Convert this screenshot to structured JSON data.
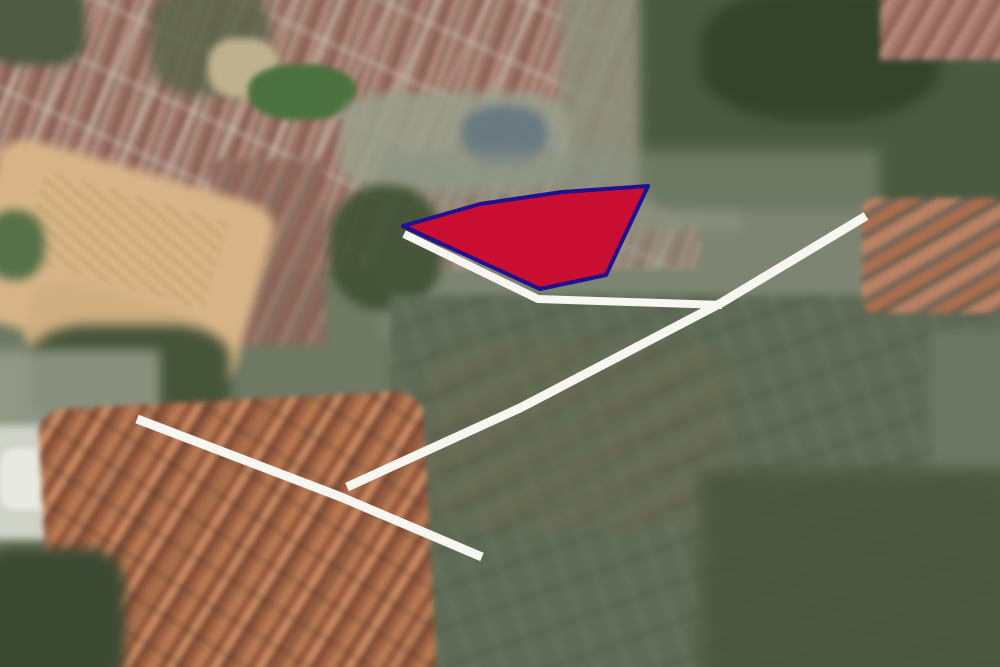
{
  "map": {
    "kind": "oblique-aerial-satellite-view",
    "canvas_width": 1000,
    "canvas_height": 667
  },
  "overlay": {
    "road_color": "#f8f6f0",
    "roads": [
      {
        "name": "parcel-frontage-road",
        "width": 8,
        "points": [
          [
            404,
            234
          ],
          [
            538,
            299
          ],
          [
            722,
            305
          ]
        ]
      },
      {
        "name": "main-access-road",
        "width": 9,
        "points": [
          [
            866,
            216
          ],
          [
            721,
            303
          ],
          [
            520,
            408
          ],
          [
            347,
            487
          ]
        ]
      },
      {
        "name": "cross-road",
        "width": 9,
        "points": [
          [
            137,
            419
          ],
          [
            341,
            497
          ],
          [
            482,
            557
          ]
        ]
      }
    ],
    "parcel": {
      "name": "highlighted-parcel",
      "fill": "#c90e31",
      "stroke": "#1f118f",
      "stroke_width": 4,
      "points": [
        [
          403,
          226
        ],
        [
          480,
          204
        ],
        [
          562,
          192
        ],
        [
          648,
          186
        ],
        [
          606,
          275
        ],
        [
          540,
          289
        ]
      ]
    }
  },
  "terrain": {
    "base_color": "#6e7862",
    "regions": [
      {
        "name": "top-left-urban",
        "x": -30,
        "y": -30,
        "w": 730,
        "h": 300,
        "blur": 3,
        "layers": [
          {
            "type": "rows",
            "angle": 115,
            "stops": [
              {
                "color": "rgba(0,0,0,0)",
                "size": 40
              },
              {
                "color": "rgba(214,208,195,0.55)",
                "size": 4
              }
            ]
          },
          {
            "type": "rows",
            "angle": 25,
            "stops": [
              {
                "color": "rgba(0,0,0,0)",
                "size": 56
              },
              {
                "color": "rgba(205,200,188,0.45)",
                "size": 4
              }
            ]
          },
          {
            "type": "rows",
            "angle": 110,
            "stops": [
              {
                "color": "#9d7164",
                "size": 9
              },
              {
                "color": "#7f5a50",
                "size": 5
              },
              {
                "color": "#b2897a",
                "size": 8
              },
              {
                "color": "#8a6a5e",
                "size": 5
              },
              {
                "color": "#c2ae9d",
                "size": 3
              }
            ]
          }
        ]
      },
      {
        "name": "top-left-corner-trees",
        "x": -15,
        "y": -15,
        "w": 100,
        "h": 80,
        "radius": "30%",
        "blur": 5,
        "layers": [
          {
            "type": "solid",
            "color": "#4e5a42"
          }
        ]
      },
      {
        "name": "upper-trees-column",
        "x": 150,
        "y": -15,
        "w": 120,
        "h": 110,
        "radius": "35%",
        "blur": 6,
        "opacity": 0.85,
        "layers": [
          {
            "type": "solid",
            "color": "#5a6349"
          }
        ]
      },
      {
        "name": "plaza-light-patch",
        "x": 208,
        "y": 38,
        "w": 70,
        "h": 60,
        "radius": "40%",
        "blur": 4,
        "opacity": 0.9,
        "layers": [
          {
            "type": "solid",
            "color": "#c9b995"
          }
        ]
      },
      {
        "name": "top-mid-fade",
        "x": 560,
        "y": -30,
        "w": 180,
        "h": 260,
        "blur": 6,
        "opacity": 0.85,
        "layers": [
          {
            "type": "solid",
            "color": "#8b8f7c"
          }
        ]
      },
      {
        "name": "top-right-forest",
        "x": 640,
        "y": -40,
        "w": 400,
        "h": 250,
        "radius": "10%",
        "blur": 6,
        "layers": [
          {
            "type": "solid",
            "color": "#4a5a41"
          }
        ]
      },
      {
        "name": "forest-dark-blob",
        "x": 700,
        "y": -10,
        "w": 240,
        "h": 130,
        "radius": "40%",
        "blur": 7,
        "layers": [
          {
            "type": "solid",
            "color": "#35432d"
          }
        ]
      },
      {
        "name": "top-right-corner-roofs",
        "x": 880,
        "y": -15,
        "w": 140,
        "h": 75,
        "blur": 3,
        "layers": [
          {
            "type": "rows",
            "angle": 120,
            "stops": [
              {
                "color": "#a3766b",
                "size": 8
              },
              {
                "color": "#855a50",
                "size": 5
              },
              {
                "color": "#b68a7c",
                "size": 7
              }
            ]
          }
        ]
      },
      {
        "name": "green-field",
        "x": 248,
        "y": 64,
        "w": 108,
        "h": 56,
        "radius": "45%",
        "blur": 3,
        "layers": [
          {
            "type": "solid",
            "color": "#4c7140"
          }
        ]
      },
      {
        "name": "campus-gray-blocks",
        "x": 340,
        "y": 92,
        "w": 230,
        "h": 100,
        "radius": "25%",
        "blur": 5,
        "opacity": 0.85,
        "layers": [
          {
            "type": "solid",
            "color": "#98a08c"
          }
        ]
      },
      {
        "name": "school-blue-roofs",
        "x": 462,
        "y": 106,
        "w": 85,
        "h": 58,
        "radius": "40%",
        "blur": 5,
        "opacity": 0.8,
        "layers": [
          {
            "type": "solid",
            "color": "#5f7180"
          }
        ]
      },
      {
        "name": "center-mixed-urban",
        "x": 380,
        "y": 150,
        "w": 500,
        "h": 190,
        "blur": 7,
        "opacity": 0.55,
        "layers": [
          {
            "type": "solid",
            "color": "#8a9180"
          }
        ]
      },
      {
        "name": "red-roof-column",
        "x": 210,
        "y": 160,
        "w": 115,
        "h": 185,
        "blur": 4,
        "opacity": 0.9,
        "layers": [
          {
            "type": "rows",
            "angle": 115,
            "stops": [
              {
                "color": "#96685c",
                "size": 8
              },
              {
                "color": "#7a564c",
                "size": 5
              },
              {
                "color": "#a87e6f",
                "size": 8
              },
              {
                "color": "#6d6458",
                "size": 4
              }
            ]
          }
        ]
      },
      {
        "name": "trees-left-of-parcel",
        "x": 328,
        "y": 185,
        "w": 115,
        "h": 125,
        "radius": "45%",
        "blur": 5,
        "opacity": 0.9,
        "layers": [
          {
            "type": "solid",
            "color": "#3f5134"
          }
        ]
      },
      {
        "name": "sand-clearing-main",
        "x": -25,
        "y": 168,
        "w": 285,
        "h": 185,
        "radius": "12%",
        "rotate": 16,
        "blur": 5,
        "layers": [
          {
            "type": "solid",
            "color": "#d8b588"
          }
        ]
      },
      {
        "name": "sand-structure-marks",
        "x": 30,
        "y": 195,
        "w": 190,
        "h": 90,
        "rotate": 16,
        "blur": 2,
        "opacity": 0.8,
        "layers": [
          {
            "type": "rows",
            "angle": 25,
            "stops": [
              {
                "color": "rgba(160,120,70,0.35)",
                "size": 4
              },
              {
                "color": "rgba(0,0,0,0)",
                "size": 8
              }
            ]
          }
        ]
      },
      {
        "name": "sand-clearing-lower",
        "x": 25,
        "y": 295,
        "w": 185,
        "h": 85,
        "radius": "30%",
        "rotate": 16,
        "blur": 5,
        "layers": [
          {
            "type": "solid",
            "color": "#cfae82"
          }
        ]
      },
      {
        "name": "left-edge-green-patch",
        "x": -15,
        "y": 210,
        "w": 60,
        "h": 70,
        "radius": "45%",
        "blur": 5,
        "layers": [
          {
            "type": "solid",
            "color": "#567048"
          }
        ]
      },
      {
        "name": "trees-below-sand",
        "x": 30,
        "y": 325,
        "w": 200,
        "h": 105,
        "radius": "30%",
        "blur": 6,
        "layers": [
          {
            "type": "solid",
            "color": "#46543a"
          }
        ]
      },
      {
        "name": "left-gray-strip",
        "x": -20,
        "y": 350,
        "w": 180,
        "h": 90,
        "blur": 6,
        "opacity": 0.8,
        "layers": [
          {
            "type": "solid",
            "color": "#9aa08e"
          }
        ]
      },
      {
        "name": "white-warehouse-cluster",
        "x": -20,
        "y": 425,
        "w": 155,
        "h": 115,
        "radius": "15%",
        "blur": 4,
        "layers": [
          {
            "type": "solid",
            "color": "#cfd2c6"
          }
        ]
      },
      {
        "name": "white-warehouse-bright",
        "x": 0,
        "y": 448,
        "w": 75,
        "h": 62,
        "radius": "20%",
        "blur": 3,
        "layers": [
          {
            "type": "solid",
            "color": "#e8e9e0"
          }
        ]
      },
      {
        "name": "fields-bottom-right",
        "x": 390,
        "y": 295,
        "w": 640,
        "h": 390,
        "blur": 4,
        "layers": [
          {
            "type": "rows",
            "angle": 160,
            "stops": [
              {
                "color": "rgba(0,0,0,0)",
                "size": 34
              },
              {
                "color": "rgba(40,45,35,0.25)",
                "size": 3
              }
            ]
          },
          {
            "type": "rows",
            "angle": 70,
            "stops": [
              {
                "color": "rgba(0,0,0,0)",
                "size": 26
              },
              {
                "color": "rgba(220,220,205,0.12)",
                "size": 3
              }
            ]
          },
          {
            "type": "solid",
            "color": "#5e6a55"
          }
        ]
      },
      {
        "name": "fields-brown-patches",
        "x": 430,
        "y": 340,
        "w": 300,
        "h": 190,
        "radius": "20%",
        "blur": 6,
        "opacity": 0.8,
        "layers": [
          {
            "type": "rows",
            "angle": 150,
            "stops": [
              {
                "color": "rgba(125,105,80,0.5)",
                "size": 12
              },
              {
                "color": "rgba(95,85,65,0.4)",
                "size": 10
              },
              {
                "color": "rgba(110,115,90,0.45)",
                "size": 14
              }
            ]
          }
        ]
      },
      {
        "name": "mid-right-roof-rows",
        "x": 862,
        "y": 198,
        "w": 145,
        "h": 115,
        "radius": "10%",
        "blur": 3,
        "opacity": 0.95,
        "layers": [
          {
            "type": "rows",
            "angle": 150,
            "stops": [
              {
                "color": "#c08263",
                "size": 14
              },
              {
                "color": "#6b6256",
                "size": 6
              },
              {
                "color": "#b06f4e",
                "size": 12
              },
              {
                "color": "#5e5a4e",
                "size": 5
              }
            ]
          }
        ]
      },
      {
        "name": "right-edge-gray",
        "x": 930,
        "y": 330,
        "w": 90,
        "h": 140,
        "blur": 6,
        "layers": [
          {
            "type": "solid",
            "color": "#6d7663"
          }
        ]
      },
      {
        "name": "bottom-right-dark-fields",
        "x": 700,
        "y": 470,
        "w": 340,
        "h": 230,
        "blur": 8,
        "opacity": 0.85,
        "layers": [
          {
            "type": "solid",
            "color": "#49553e"
          }
        ]
      },
      {
        "name": "bottom-left-village",
        "x": 45,
        "y": 400,
        "w": 385,
        "h": 290,
        "radius": "8%",
        "rotate": -3,
        "blur": 3,
        "layers": [
          {
            "type": "rows",
            "angle": 35,
            "stops": [
              {
                "color": "rgba(0,0,0,0)",
                "size": 30
              },
              {
                "color": "rgba(60,50,40,0.35)",
                "size": 3
              }
            ]
          },
          {
            "type": "rows",
            "angle": 125,
            "stops": [
              {
                "color": "rgba(0,0,0,0)",
                "size": 46
              },
              {
                "color": "rgba(60,50,40,0.3)",
                "size": 3
              }
            ]
          },
          {
            "type": "rows",
            "angle": 125,
            "stops": [
              {
                "color": "#b97a52",
                "size": 10
              },
              {
                "color": "#8a4e35",
                "size": 6
              },
              {
                "color": "#c98a61",
                "size": 9
              },
              {
                "color": "#74422e",
                "size": 5
              },
              {
                "color": "#9c5f41",
                "size": 8
              }
            ]
          }
        ]
      },
      {
        "name": "bottom-left-corner-trees",
        "x": -25,
        "y": 548,
        "w": 150,
        "h": 140,
        "radius": "25%",
        "blur": 6,
        "layers": [
          {
            "type": "solid",
            "color": "#3c4a33"
          }
        ]
      }
    ]
  }
}
